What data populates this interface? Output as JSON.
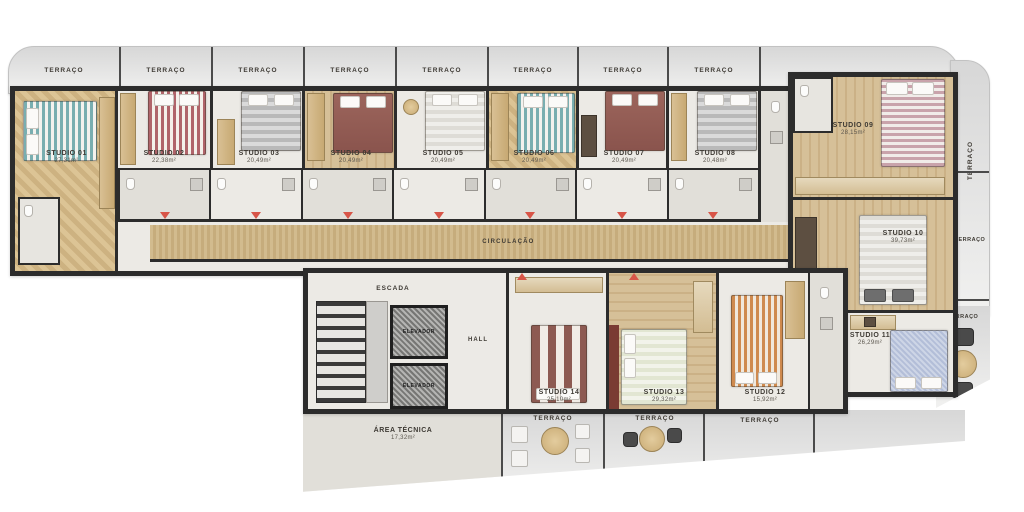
{
  "palette": {
    "wall": "#2c2c2c",
    "wood": "#d2bb8e",
    "tile": "#eceae5",
    "terrace_gray": "#e4e4e4",
    "accent_red": "#d85548",
    "label_text": "#3e3a34"
  },
  "icons": {
    "entry_marker": "red-triangle-down",
    "round_table": "tan-circle",
    "chair": "dark-rounded-square"
  },
  "terraces": {
    "top": [
      "TERRAÇO",
      "TERRAÇO",
      "TERRAÇO",
      "TERRAÇO",
      "TERRAÇO",
      "TERRAÇO",
      "TERRAÇO",
      "TERRAÇO"
    ],
    "right": [
      "TERRAÇO",
      "TERRAÇO",
      "TERRAÇO"
    ],
    "bottom": [
      "TERRAÇO",
      "TERRAÇO",
      "TERRAÇO"
    ]
  },
  "studios": [
    {
      "name": "STUDIO 01",
      "area": "27,31m²"
    },
    {
      "name": "STUDIO 02",
      "area": "22,38m²"
    },
    {
      "name": "STUDIO 03",
      "area": "20,49m²"
    },
    {
      "name": "STUDIO 04",
      "area": "20,49m²"
    },
    {
      "name": "STUDIO 05",
      "area": "20,49m²"
    },
    {
      "name": "STUDIO 06",
      "area": "20,49m²"
    },
    {
      "name": "STUDIO 07",
      "area": "20,49m²"
    },
    {
      "name": "STUDIO 08",
      "area": "20,48m²"
    },
    {
      "name": "STUDIO 09",
      "area": "28,15m²"
    },
    {
      "name": "STUDIO 10",
      "area": "39,73m²"
    },
    {
      "name": "STUDIO 11",
      "area": "26,29m²"
    },
    {
      "name": "STUDIO 12",
      "area": "15,92m²"
    },
    {
      "name": "STUDIO 13",
      "area": "29,32m²"
    },
    {
      "name": "STUDIO 14",
      "area": "25,10m²"
    }
  ],
  "circulation": {
    "label": "CIRCULAÇÃO"
  },
  "core": {
    "stairs_label": "ESCADA",
    "elevator_1_label": "ELEVADOR",
    "elevator_2_label": "ELEVADOR",
    "hall_label": "HALL",
    "technical_area": {
      "name": "ÁREA TÉCNICA",
      "area": "17,32m²"
    }
  }
}
